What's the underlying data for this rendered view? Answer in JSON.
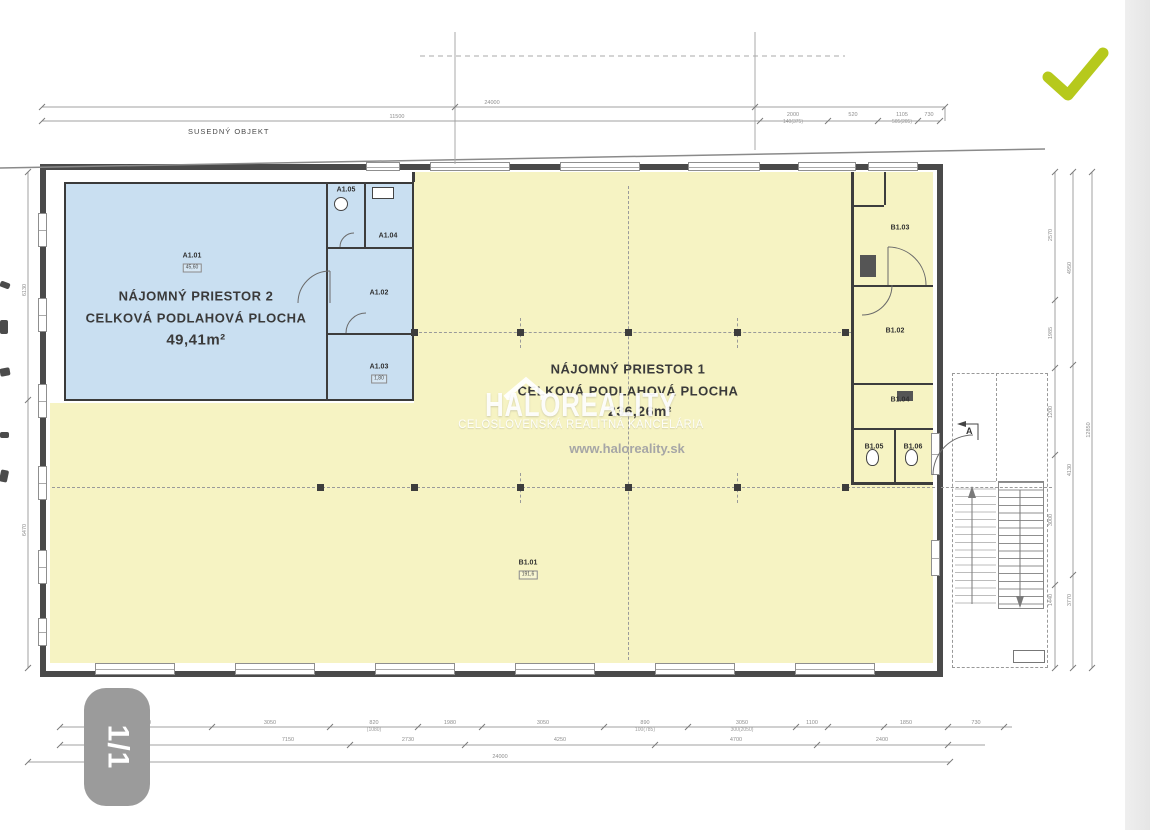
{
  "page": {
    "badge_label": "1/1"
  },
  "colors": {
    "accent_check": "#b6c91c",
    "space1_fill": "#f6f3c3",
    "space2_fill": "#c9dff1"
  },
  "watermark": {
    "brand": "HALOREALITY",
    "subtitle": "CELOSLOVENSKÁ REALITNÁ KANCELÁRIA",
    "url": "www.haloreality.sk"
  },
  "plan": {
    "neighbor_label": "SUSEDNÝ OBJEKT",
    "section_marker": "A",
    "space2": {
      "line1": "NÁJOMNÝ PRIESTOR 2",
      "line2": "CELKOVÁ PODLAHOVÁ PLOCHA",
      "area": "49,41m²"
    },
    "space1": {
      "line1": "NÁJOMNÝ PRIESTOR 1",
      "line2": "CELKOVÁ PODLAHOVÁ PLOCHA",
      "area": "236,26m²"
    },
    "rooms": [
      {
        "id": "A1.01",
        "x": 192,
        "y": 256,
        "box": "45,60"
      },
      {
        "id": "A1.02",
        "x": 379,
        "y": 293
      },
      {
        "id": "A1.03",
        "x": 379,
        "y": 367,
        "box": "1,80"
      },
      {
        "id": "A1.04",
        "x": 388,
        "y": 236
      },
      {
        "id": "A1.05",
        "x": 346,
        "y": 190
      },
      {
        "id": "B1.01",
        "x": 528,
        "y": 563,
        "box": "191,6"
      },
      {
        "id": "B1.02",
        "x": 895,
        "y": 331
      },
      {
        "id": "B1.03",
        "x": 900,
        "y": 228
      },
      {
        "id": "B1.04",
        "x": 900,
        "y": 400
      },
      {
        "id": "B1.05",
        "x": 874,
        "y": 447
      },
      {
        "id": "B1.06",
        "x": 913,
        "y": 447
      }
    ],
    "dims": {
      "top": [
        {
          "t": "24000",
          "x": 492,
          "y": 103
        },
        {
          "t": "11500",
          "x": 397,
          "y": 117
        },
        {
          "t": "2000",
          "x": 793,
          "y": 115,
          "sub": "140(375)"
        },
        {
          "t": "520",
          "x": 853,
          "y": 115
        },
        {
          "t": "1105",
          "x": 902,
          "y": 115,
          "sub": "505(205)"
        },
        {
          "t": "730",
          "x": 929,
          "y": 115
        }
      ],
      "bottom1": [
        {
          "t": "5700",
          "x": 145,
          "y": 723
        },
        {
          "t": "3050",
          "x": 270,
          "y": 723
        },
        {
          "t": "820",
          "x": 374,
          "y": 723,
          "sub": "(1080)"
        },
        {
          "t": "1980",
          "x": 450,
          "y": 723
        },
        {
          "t": "3050",
          "x": 543,
          "y": 723
        },
        {
          "t": "890",
          "x": 645,
          "y": 723,
          "sub": "100(785)"
        },
        {
          "t": "3050",
          "x": 742,
          "y": 723,
          "sub": "300(2050)"
        },
        {
          "t": "1100",
          "x": 812,
          "y": 723
        },
        {
          "t": "1850",
          "x": 906,
          "y": 723
        },
        {
          "t": "730",
          "x": 976,
          "y": 723
        }
      ],
      "bottom2": [
        {
          "t": "7150",
          "x": 288,
          "y": 740
        },
        {
          "t": "2730",
          "x": 408,
          "y": 740
        },
        {
          "t": "4250",
          "x": 560,
          "y": 740
        },
        {
          "t": "4700",
          "x": 736,
          "y": 740
        },
        {
          "t": "2400",
          "x": 882,
          "y": 740
        }
      ],
      "bottom3": [
        {
          "t": "24000",
          "x": 500,
          "y": 757
        }
      ],
      "right": [
        {
          "t": "2570",
          "x": 1051,
          "y": 235
        },
        {
          "t": "1985",
          "x": 1051,
          "y": 333
        },
        {
          "t": "1200",
          "x": 1051,
          "y": 412
        },
        {
          "t": "3000",
          "x": 1051,
          "y": 520
        },
        {
          "t": "1440",
          "x": 1051,
          "y": 600
        },
        {
          "t": "4950",
          "x": 1070,
          "y": 268
        },
        {
          "t": "4130",
          "x": 1070,
          "y": 470
        },
        {
          "t": "3770",
          "x": 1070,
          "y": 600
        },
        {
          "t": "12850",
          "x": 1089,
          "y": 430
        }
      ],
      "left": [
        {
          "t": "6130",
          "x": 25,
          "y": 290
        },
        {
          "t": "6470",
          "x": 25,
          "y": 530
        }
      ]
    }
  }
}
